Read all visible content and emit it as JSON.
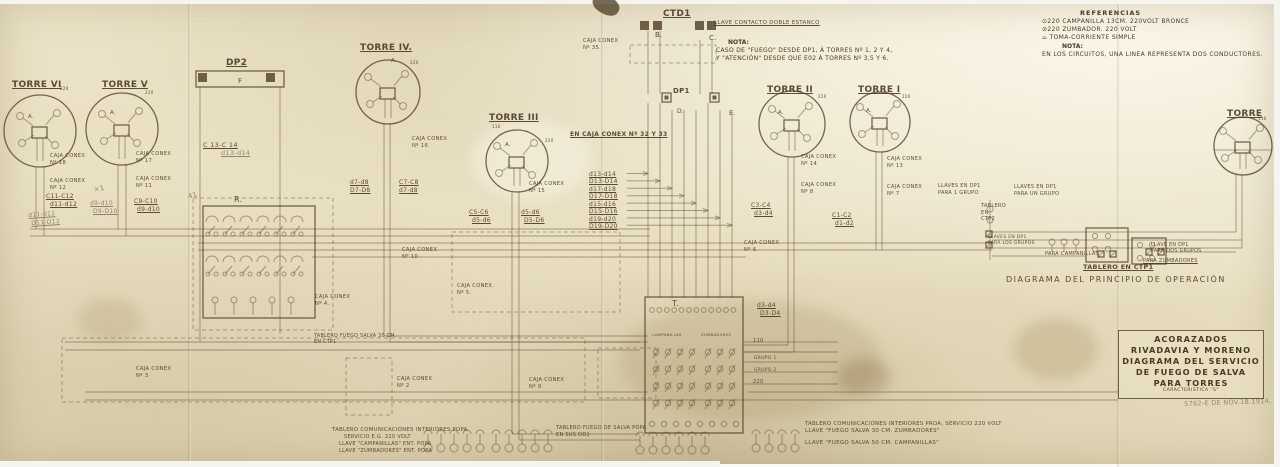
{
  "colors": {
    "paper": "#e9e0c3",
    "ink": "#4f3f25",
    "pencil": "#7c6f5c"
  },
  "references": {
    "title": "REFERENCIAS",
    "lines": [
      "⊙220 CAMPANILLA 13CM. 220VOLT  BRONCE",
      "⊘220 ZUMBADOR.      220 VOLT",
      "⌓   TOMA-CORRIENTE SIMPLE"
    ],
    "nota_label": "NOTA:",
    "nota": "EN LOS CIRCUITOS, UNA LINEA REPRESENTA DOS CONDUCTORES."
  },
  "center_note": {
    "label": "NOTA:",
    "lines": [
      "CASO DE \"FUEGO\" DESDE DP1, Á TORRES Nº 1, 2 Y 4,",
      "Y \"ATENCIÓN\" DESDE QUE E02 Á TORRES Nº 3,5 Y 6."
    ]
  },
  "title_block": {
    "lines": [
      "ACORAZADOS",
      "RIVADAVIA Y MORENO",
      "DIAGRAMA DEL SERVICIO",
      "DE FUEGO DE SALVA",
      "PARA TORRES"
    ],
    "subline": "CARACTERISTICA \"S\""
  },
  "torres": [
    {
      "name": "TORRE VI",
      "cx": 40,
      "cy": 131,
      "r": 36,
      "lx": 12,
      "ly": 80
    },
    {
      "name": "TORRE V",
      "cx": 122,
      "cy": 129,
      "r": 36,
      "lx": 102,
      "ly": 80
    },
    {
      "name": "TORRE IV.",
      "cx": 388,
      "cy": 92,
      "r": 32,
      "lx": 360,
      "ly": 43
    },
    {
      "name": "TORRE III",
      "cx": 517,
      "cy": 161,
      "r": 31,
      "lx": 489,
      "ly": 113
    },
    {
      "name": "TORRE II",
      "cx": 792,
      "cy": 124,
      "r": 33,
      "lx": 767,
      "ly": 85
    },
    {
      "name": "TORRE I",
      "cx": 880,
      "cy": 122,
      "r": 30,
      "lx": 858,
      "ly": 85
    },
    {
      "name": "TORRE",
      "cx": 1243,
      "cy": 146,
      "r": 29,
      "lx": 1227,
      "ly": 109
    }
  ],
  "annotations": [
    {
      "t": "DP2",
      "x": 226,
      "y": 58,
      "fs": 9,
      "b": 1,
      "u": 1
    },
    {
      "t": "F",
      "x": 238,
      "y": 77,
      "fs": 7
    },
    {
      "t": "R.",
      "x": 234,
      "y": 195,
      "fs": 8
    },
    {
      "t": "CTD1",
      "x": 663,
      "y": 9,
      "fs": 9,
      "b": 1,
      "u": 1
    },
    {
      "t": "LLAVE CONTACTO DOBLE ESTANCO",
      "x": 714,
      "y": 20,
      "fs": 5.5,
      "u": 1
    },
    {
      "t": "B.",
      "x": 655,
      "y": 31,
      "fs": 7
    },
    {
      "t": "C.",
      "x": 709,
      "y": 34,
      "fs": 7
    },
    {
      "t": "DP1",
      "x": 673,
      "y": 87,
      "fs": 7,
      "b": 1
    },
    {
      "t": "D.",
      "x": 677,
      "y": 108,
      "fs": 6
    },
    {
      "t": "E.",
      "x": 729,
      "y": 110,
      "fs": 6
    },
    {
      "t": "T.",
      "x": 672,
      "y": 299,
      "fs": 8
    },
    {
      "t": "CAJA CONEX\nNº 35.",
      "x": 583,
      "y": 38
    },
    {
      "t": "CAJA CONEX\nNº 18",
      "x": 50,
      "y": 153
    },
    {
      "t": "CAJA CONEX\nNº 12",
      "x": 50,
      "y": 178
    },
    {
      "t": "CAJA CONEX\nNº 17",
      "x": 136,
      "y": 151
    },
    {
      "t": "CAJA CONEX\nNº 11",
      "x": 136,
      "y": 176
    },
    {
      "t": "CAJA CONEX\nNº 16",
      "x": 412,
      "y": 136
    },
    {
      "t": "CAJA CONEX\nNº 15",
      "x": 529,
      "y": 181
    },
    {
      "t": "EN CAJA CONEX Nº 32 Y 33",
      "x": 570,
      "y": 131,
      "fs": 6,
      "u": 1,
      "b": 1
    },
    {
      "t": "CAJA CONEX\nNº 14",
      "x": 801,
      "y": 154
    },
    {
      "t": "CAJA CONEX\nNº 8",
      "x": 801,
      "y": 182
    },
    {
      "t": "CAJA CONEX\nNº 13",
      "x": 887,
      "y": 156
    },
    {
      "t": "CAJA CONEX\nNº 7",
      "x": 887,
      "y": 184
    },
    {
      "t": "LLAVES EN DP1\nPARA 1 GRUPO",
      "x": 938,
      "y": 183,
      "fs": 5
    },
    {
      "t": "CAJA CONEX\nNº 10",
      "x": 402,
      "y": 247
    },
    {
      "t": "CAJA CONEX\nNº 4.",
      "x": 315,
      "y": 294
    },
    {
      "t": "CAJA CONEX.\nNº 5.",
      "x": 457,
      "y": 283
    },
    {
      "t": "CAJA CONEX\nNº 6",
      "x": 744,
      "y": 240
    },
    {
      "t": "CAJA CONEX\nNº 3",
      "x": 136,
      "y": 366
    },
    {
      "t": "CAJA CONEX\nNº 2",
      "x": 397,
      "y": 376
    },
    {
      "t": "CAJA CONEX\nNº 9",
      "x": 529,
      "y": 377
    },
    {
      "t": "C 13-C 14",
      "x": 203,
      "y": 141,
      "fs": 6.5,
      "u": 1
    },
    {
      "t": "d13-d14",
      "x": 221,
      "y": 149,
      "fs": 6.5,
      "u": 1,
      "cls": "pencil"
    },
    {
      "t": "d7-d8",
      "x": 350,
      "y": 179,
      "fs": 6,
      "u": 1
    },
    {
      "t": "D7-D8",
      "x": 350,
      "y": 187,
      "fs": 6,
      "u": 1
    },
    {
      "t": "C7-C8",
      "x": 399,
      "y": 179,
      "fs": 6,
      "u": 1
    },
    {
      "t": "d7-d8",
      "x": 399,
      "y": 187,
      "fs": 6,
      "u": 1
    },
    {
      "t": "C11-C12",
      "x": 46,
      "y": 193,
      "fs": 6,
      "u": 1
    },
    {
      "t": "d11-d12",
      "x": 50,
      "y": 201,
      "fs": 6,
      "u": 1
    },
    {
      "t": "d11-d12",
      "x": 28,
      "y": 212,
      "fs": 6,
      "u": 1,
      "cls": "pencil",
      "rot": -4
    },
    {
      "t": "D11-D12",
      "x": 31,
      "y": 220,
      "fs": 6,
      "u": 1,
      "cls": "pencil",
      "rot": -4
    },
    {
      "t": "d9-d10",
      "x": 90,
      "y": 200,
      "fs": 6,
      "u": 1,
      "cls": "pencil"
    },
    {
      "t": "D9-D10",
      "x": 93,
      "y": 208,
      "fs": 6,
      "u": 1,
      "cls": "pencil"
    },
    {
      "t": "C9-C10",
      "x": 134,
      "y": 198,
      "fs": 6,
      "u": 1
    },
    {
      "t": "d9-d10",
      "x": 137,
      "y": 206,
      "fs": 6,
      "u": 1
    },
    {
      "t": "d13-d14",
      "x": 589,
      "y": 171,
      "fs": 6,
      "u": 1
    },
    {
      "t": "D13-D14",
      "x": 589,
      "y": 178,
      "fs": 6,
      "u": 1
    },
    {
      "t": "d17-d18",
      "x": 589,
      "y": 186,
      "fs": 6,
      "u": 1
    },
    {
      "t": "D17-D18",
      "x": 589,
      "y": 193,
      "fs": 6,
      "u": 1
    },
    {
      "t": "d15-d16",
      "x": 589,
      "y": 201,
      "fs": 6,
      "u": 1
    },
    {
      "t": "D15-D16",
      "x": 589,
      "y": 208,
      "fs": 6,
      "u": 1
    },
    {
      "t": "d19-d20",
      "x": 589,
      "y": 216,
      "fs": 6,
      "u": 1
    },
    {
      "t": "D19-D20",
      "x": 589,
      "y": 223,
      "fs": 6,
      "u": 1
    },
    {
      "t": "C5-C6",
      "x": 469,
      "y": 209,
      "fs": 6,
      "u": 1
    },
    {
      "t": "d5-d6",
      "x": 472,
      "y": 217,
      "fs": 6,
      "u": 1
    },
    {
      "t": "d5-d6",
      "x": 521,
      "y": 209,
      "fs": 6,
      "u": 1
    },
    {
      "t": "D5-D6",
      "x": 524,
      "y": 217,
      "fs": 6,
      "u": 1
    },
    {
      "t": "C3-C4",
      "x": 751,
      "y": 202,
      "fs": 6,
      "u": 1
    },
    {
      "t": "d3-d4",
      "x": 754,
      "y": 210,
      "fs": 6,
      "u": 1
    },
    {
      "t": "C1-C2",
      "x": 832,
      "y": 212,
      "fs": 6,
      "u": 1
    },
    {
      "t": "d1-d2",
      "x": 835,
      "y": 220,
      "fs": 6,
      "u": 1
    },
    {
      "t": "d3-d4",
      "x": 757,
      "y": 302,
      "fs": 6,
      "u": 1
    },
    {
      "t": "D3-D4",
      "x": 760,
      "y": 310,
      "fs": 6,
      "u": 1
    },
    {
      "t": "110",
      "x": 753,
      "y": 338,
      "fs": 5
    },
    {
      "t": "GRUPO 1",
      "x": 754,
      "y": 356,
      "fs": 4.5
    },
    {
      "t": "GRUPO 2",
      "x": 754,
      "y": 368,
      "fs": 4.5
    },
    {
      "t": "220",
      "x": 753,
      "y": 379,
      "fs": 5
    },
    {
      "t": "CAMPANILLAS",
      "x": 652,
      "y": 333,
      "fs": 3.8
    },
    {
      "t": "ZUMBADORES",
      "x": 701,
      "y": 333,
      "fs": 3.8
    },
    {
      "t": "LLAVES EN DP1\nPARA UN GRUPO",
      "x": 1014,
      "y": 184,
      "fs": 5
    },
    {
      "t": "TABLERO\nEN\nCTP2",
      "x": 981,
      "y": 203,
      "fs": 5
    },
    {
      "t": "LLAVES EN DP1\nPARA LOS GRUPOS",
      "x": 988,
      "y": 235,
      "fs": 4.5
    },
    {
      "t": "PARA CAMPANILLAS",
      "x": 1045,
      "y": 251,
      "fs": 5
    },
    {
      "t": "TABLERO EN CTP1",
      "x": 1083,
      "y": 263,
      "fs": 6.5,
      "u": 1,
      "b": 1
    },
    {
      "t": "LLAVE EN DP1\nPARA DOS GRUPOS",
      "x": 1151,
      "y": 243,
      "fs": 4.8
    },
    {
      "t": "PARA ZUMBADORES",
      "x": 1143,
      "y": 258,
      "fs": 5,
      "u": 1
    },
    {
      "t": "DIAGRAMA DEL PRINCIPIO DE OPERACIÓN",
      "x": 1006,
      "y": 275,
      "fs": 8,
      "ls": 1.5
    },
    {
      "t": "TABLERO COMUNICACIONES INTERIORES POPA",
      "x": 332,
      "y": 427,
      "fs": 5.3
    },
    {
      "t": "SERVICIO E.G. 220 VOLT",
      "x": 344,
      "y": 434,
      "fs": 5
    },
    {
      "t": "LLAVE \"CAMPANILLAS\" ENT. POPA",
      "x": 339,
      "y": 441,
      "fs": 5
    },
    {
      "t": "LLAVE \"ZUMBADORES\" ENT. POPA",
      "x": 339,
      "y": 448,
      "fs": 5
    },
    {
      "t": "TABLERO FUEGO DE SALVA POPA\nEN SUS DD1",
      "x": 556,
      "y": 425,
      "fs": 5
    },
    {
      "t": "TABLERO COMUNICACIONES INTERIORES PROA, SERVICIO 220 VOLT",
      "x": 805,
      "y": 421,
      "fs": 5.3
    },
    {
      "t": "LLAVE \"FUEGO SALVA 30 CM. ZUMBADORES\"",
      "x": 805,
      "y": 428,
      "fs": 5.5
    },
    {
      "t": "LLAVE \"FUEGO SALVA 50 CM. CAMPANILLAS\"",
      "x": 805,
      "y": 440,
      "fs": 5.5
    },
    {
      "t": "TABLERO FUEGO SALVA 30 CM.\nEN CTP1",
      "x": 314,
      "y": 334,
      "fs": 4.8
    },
    {
      "t": "220",
      "x": 60,
      "y": 86,
      "fs": 4
    },
    {
      "t": "220",
      "x": 145,
      "y": 90,
      "fs": 4
    },
    {
      "t": "220",
      "x": 410,
      "y": 60,
      "fs": 4
    },
    {
      "t": "110",
      "x": 492,
      "y": 124,
      "fs": 4
    },
    {
      "t": "220",
      "x": 545,
      "y": 138,
      "fs": 4
    },
    {
      "t": "220",
      "x": 818,
      "y": 94,
      "fs": 4
    },
    {
      "t": "220",
      "x": 902,
      "y": 94,
      "fs": 4
    },
    {
      "t": "110",
      "x": 1258,
      "y": 116,
      "fs": 4
    },
    {
      "t": "A.",
      "x": 28,
      "y": 114,
      "fs": 5.5
    },
    {
      "t": "A.",
      "x": 110,
      "y": 110,
      "fs": 5.5
    },
    {
      "t": "A.",
      "x": 391,
      "y": 58,
      "fs": 5.5
    },
    {
      "t": "A.",
      "x": 505,
      "y": 142,
      "fs": 5.5
    },
    {
      "t": "A.",
      "x": 778,
      "y": 110,
      "fs": 5.5
    },
    {
      "t": "A.",
      "x": 866,
      "y": 108,
      "fs": 5.5
    },
    {
      "t": "×1",
      "x": 93,
      "y": 186,
      "fs": 7,
      "cls": "pencil",
      "rot": -12
    },
    {
      "t": "41",
      "x": 187,
      "y": 193,
      "fs": 7,
      "cls": "pencil",
      "rot": -15
    },
    {
      "t": "5762-E DE NOV.18.1914.",
      "x": 1184,
      "y": 400,
      "fs": 6.5,
      "cls": "pencil",
      "rot": -2
    }
  ]
}
